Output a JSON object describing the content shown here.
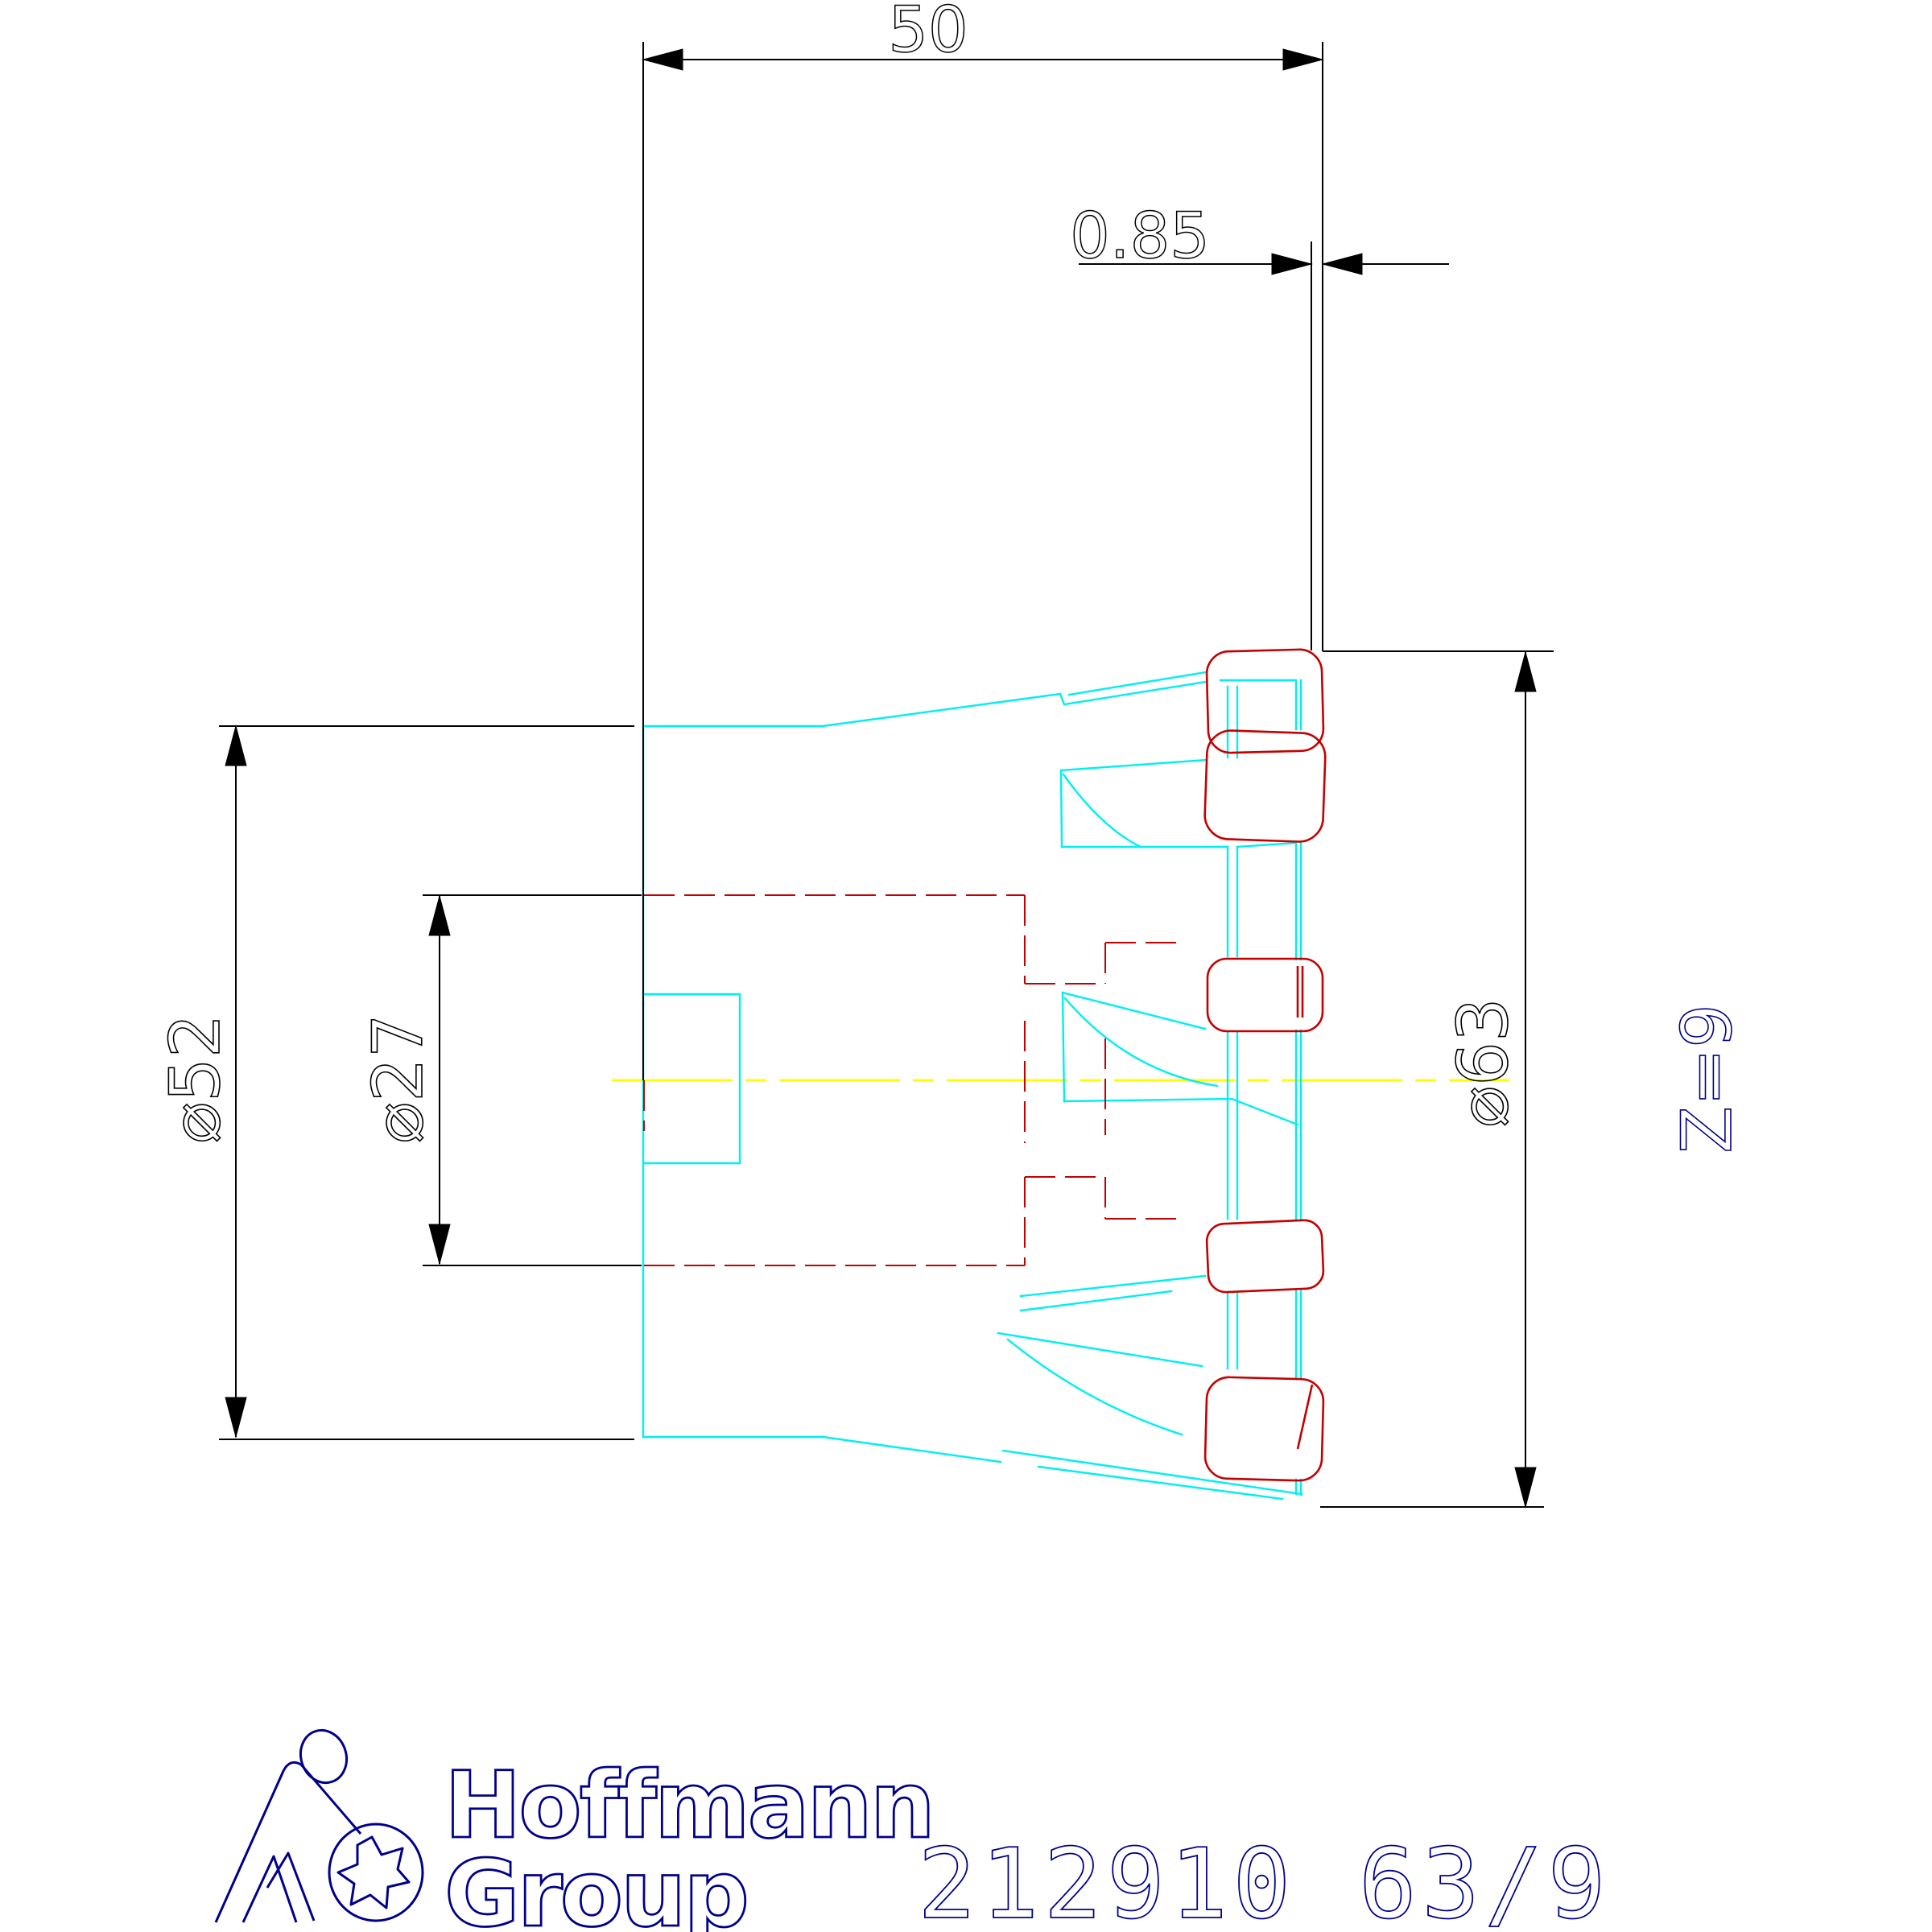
{
  "drawing": {
    "dim_overall_length": "50",
    "dim_insert_protrusion": "0.85",
    "dim_shank_diameter": "⌀52",
    "dim_bore_diameter": "⌀27",
    "dim_cutting_diameter": "⌀63",
    "dim_number_of_teeth": "Z=9"
  },
  "footer": {
    "brand_line1": "Hoffmann",
    "brand_line2": "Group",
    "part_number": "212910 63/9"
  },
  "colors": {
    "background": "#ffffff",
    "dimension_black": "#000000",
    "body_cyan": "#00efef",
    "insert_red": "#c40000",
    "centerline_yellow": "#ffff00",
    "brand_navy": "#00008b"
  }
}
